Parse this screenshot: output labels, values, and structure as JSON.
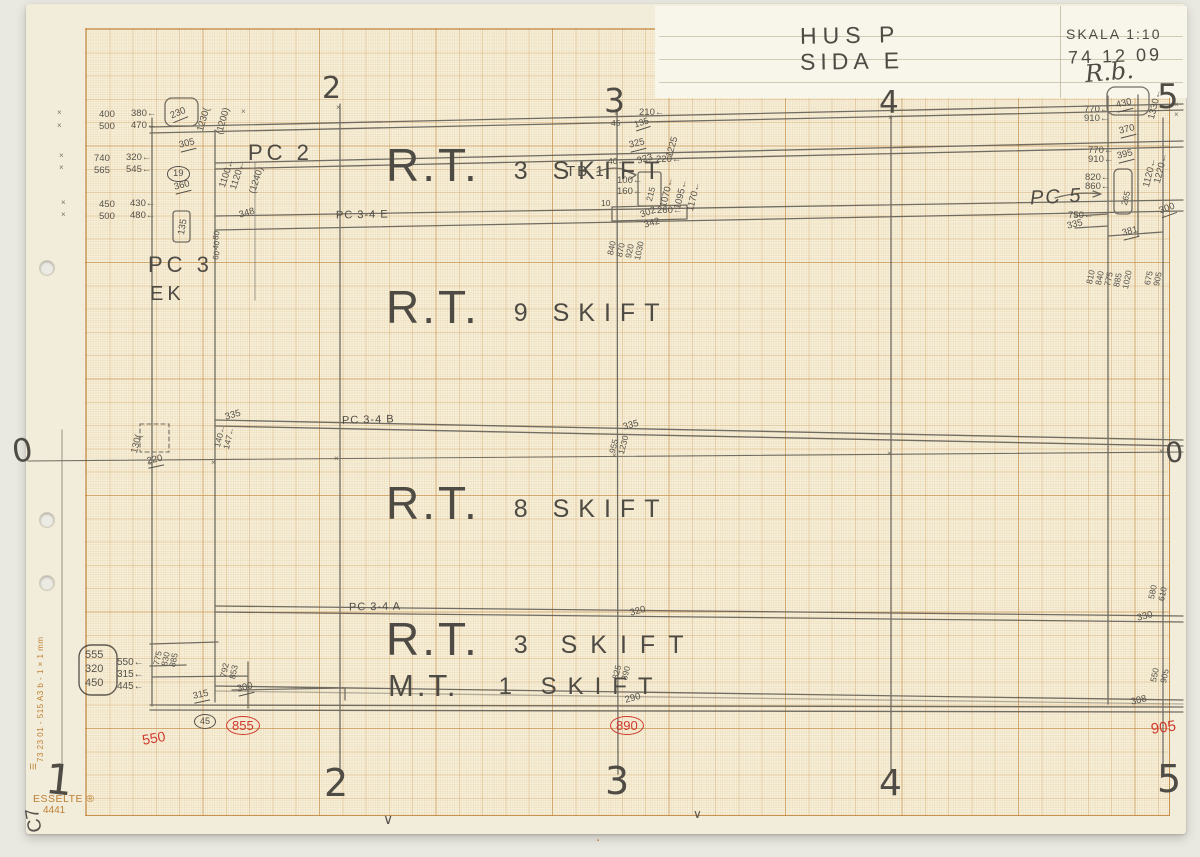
{
  "colors": {
    "pencil": "#56524b",
    "red": "#cf3a30",
    "orange": "#bd7f33",
    "paper": "#f2edda",
    "grid": "#c9955299"
  },
  "title_block": {
    "project": "HUS P",
    "side": "SIDA E",
    "scale": "SKALA 1:10",
    "date": "74 12 09",
    "signature": "R.b."
  },
  "paper": {
    "brand": "ESSELTE ®",
    "product_no": "4441",
    "margin_code": "73 23 01 - 515 A3 b - 1 × 1 mm",
    "corner_mark": "C7"
  },
  "components": {
    "pc2": "PC 2",
    "pc3": "PC 3",
    "ek": "EK",
    "pc34e": "PC 3-4 E",
    "pc34b": "PC 3-4 B",
    "pc34a": "PC 3-4 A",
    "tb1": "TB 1",
    "pc5": "PC 5"
  },
  "zones": [
    {
      "main": "R.T.",
      "sub": "3 SKIFT"
    },
    {
      "main": "R.T.",
      "sub": "9 SKIFT"
    },
    {
      "main": "R.T.",
      "sub": "8 SKIFT"
    },
    {
      "main": "R.T.",
      "sub": "3 SKIFT"
    },
    {
      "main": "M.T.",
      "sub": "1 SKIFT"
    }
  ],
  "annotations": [
    {
      "t": "2",
      "x": 322,
      "y": 74,
      "s": 30,
      "cls": "axis",
      "n": "axis-numeral-top-2"
    },
    {
      "t": "3",
      "x": 604,
      "y": 84,
      "s": 33,
      "cls": "axis",
      "n": "axis-numeral-top-3"
    },
    {
      "t": "4",
      "x": 879,
      "y": 88,
      "s": 31,
      "cls": "axis",
      "n": "axis-numeral-top-4"
    },
    {
      "t": "5",
      "x": 1157,
      "y": 80,
      "s": 34,
      "cls": "axis",
      "n": "axis-numeral-top-5"
    },
    {
      "t": "1",
      "x": 48,
      "y": 758,
      "s": 42,
      "r": 6,
      "cls": "axis",
      "n": "axis-numeral-bottom-1"
    },
    {
      "t": "2",
      "x": 324,
      "y": 764,
      "s": 38,
      "cls": "axis",
      "n": "axis-numeral-bottom-2"
    },
    {
      "t": "3",
      "x": 605,
      "y": 762,
      "s": 38,
      "cls": "axis",
      "n": "axis-numeral-bottom-3"
    },
    {
      "t": "4",
      "x": 879,
      "y": 766,
      "s": 36,
      "cls": "axis",
      "n": "axis-numeral-bottom-4"
    },
    {
      "t": "5",
      "x": 1157,
      "y": 760,
      "s": 38,
      "cls": "axis",
      "n": "axis-numeral-bottom-5"
    },
    {
      "t": "0",
      "x": 10,
      "y": 436,
      "s": 32,
      "r": -8,
      "cls": "axis",
      "n": "datum-zero-left"
    },
    {
      "t": "0",
      "x": 1164,
      "y": 440,
      "s": 28,
      "r": -6,
      "cls": "axis",
      "n": "datum-zero-right"
    },
    {
      "t": "400",
      "x": 99,
      "y": 110
    },
    {
      "t": "380←",
      "x": 131,
      "y": 109
    },
    {
      "t": "500",
      "x": 99,
      "y": 122
    },
    {
      "t": "470←",
      "x": 131,
      "y": 121
    },
    {
      "t": "230",
      "x": 169,
      "y": 112,
      "r": -22,
      "cls": "u"
    },
    {
      "t": "1230(",
      "x": 196,
      "y": 130,
      "r": -74
    },
    {
      "t": "(1200)",
      "x": 215,
      "y": 133,
      "r": -74
    },
    {
      "t": "305",
      "x": 178,
      "y": 141,
      "r": -14,
      "cls": "u"
    },
    {
      "t": "740",
      "x": 94,
      "y": 154
    },
    {
      "t": "320←",
      "x": 126,
      "y": 153
    },
    {
      "t": "565",
      "x": 94,
      "y": 166
    },
    {
      "t": "545←",
      "x": 126,
      "y": 165
    },
    {
      "t": "19",
      "x": 167,
      "y": 166,
      "cls": "circ"
    },
    {
      "t": "360",
      "x": 173,
      "y": 183,
      "r": -14,
      "cls": "u"
    },
    {
      "t": "1100←",
      "x": 218,
      "y": 186,
      "r": -72
    },
    {
      "t": "1120←",
      "x": 229,
      "y": 188,
      "r": -72
    },
    {
      "t": "(1240)",
      "x": 248,
      "y": 192,
      "r": -72
    },
    {
      "t": "450",
      "x": 99,
      "y": 200
    },
    {
      "t": "430←",
      "x": 130,
      "y": 199
    },
    {
      "t": "500",
      "x": 99,
      "y": 212
    },
    {
      "t": "480←",
      "x": 130,
      "y": 211
    },
    {
      "t": "135",
      "x": 177,
      "y": 234,
      "r": -80
    },
    {
      "t": "348",
      "x": 238,
      "y": 211,
      "r": -16
    },
    {
      "t": "80",
      "x": 212,
      "y": 239,
      "r": -78,
      "s": 8
    },
    {
      "t": "40",
      "x": 212,
      "y": 249,
      "r": -78,
      "s": 8
    },
    {
      "t": "60",
      "x": 212,
      "y": 259,
      "r": -78,
      "s": 8
    },
    {
      "t": "130(",
      "x": 130,
      "y": 452,
      "r": -76
    },
    {
      "t": "220",
      "x": 146,
      "y": 457,
      "r": -12,
      "cls": "u"
    },
    {
      "t": "335",
      "x": 224,
      "y": 413,
      "r": -16
    },
    {
      "t": "140←",
      "x": 213,
      "y": 446,
      "r": -76,
      "s": 8.5
    },
    {
      "t": "147←",
      "x": 222,
      "y": 448,
      "r": -76,
      "s": 8.5
    },
    {
      "t": "210←",
      "x": 639,
      "y": 108
    },
    {
      "t": "45",
      "x": 611,
      "y": 119,
      "s": 8.5
    },
    {
      "t": "135",
      "x": 633,
      "y": 121,
      "r": -18,
      "cls": "u",
      "s": 9
    },
    {
      "t": "325",
      "x": 628,
      "y": 141,
      "r": -14,
      "cls": "u"
    },
    {
      "t": "1225",
      "x": 665,
      "y": 156,
      "r": -74
    },
    {
      "t": "40←",
      "x": 608,
      "y": 157,
      "s": 8.5
    },
    {
      "t": "323",
      "x": 636,
      "y": 157,
      "r": -16
    },
    {
      "t": "220←",
      "x": 656,
      "y": 155
    },
    {
      "t": "100←",
      "x": 617,
      "y": 176
    },
    {
      "t": "160←",
      "x": 617,
      "y": 187
    },
    {
      "t": "215",
      "x": 645,
      "y": 200,
      "r": -76,
      "s": 8.5
    },
    {
      "t": "1070←",
      "x": 659,
      "y": 206,
      "r": -76
    },
    {
      "t": "1095←",
      "x": 673,
      "y": 208,
      "r": -76
    },
    {
      "t": "1170←",
      "x": 686,
      "y": 210,
      "r": -76
    },
    {
      "t": "10",
      "x": 601,
      "y": 199,
      "s": 8.5
    },
    {
      "t": "302",
      "x": 639,
      "y": 211,
      "r": -20
    },
    {
      "t": "342",
      "x": 643,
      "y": 221,
      "r": -16
    },
    {
      "t": "260←",
      "x": 657,
      "y": 206
    },
    {
      "t": "840",
      "x": 606,
      "y": 254,
      "r": -78,
      "s": 8.5
    },
    {
      "t": "870",
      "x": 615,
      "y": 256,
      "r": -78,
      "s": 8.5
    },
    {
      "t": "920",
      "x": 624,
      "y": 257,
      "r": -78,
      "s": 8.5
    },
    {
      "t": "1030",
      "x": 633,
      "y": 259,
      "r": -78,
      "s": 8.5
    },
    {
      "t": "335",
      "x": 622,
      "y": 423,
      "r": -15
    },
    {
      "t": "955",
      "x": 608,
      "y": 452,
      "r": -76,
      "s": 8.5
    },
    {
      "t": "1230",
      "x": 617,
      "y": 453,
      "r": -76,
      "s": 8.5
    },
    {
      "t": "320",
      "x": 629,
      "y": 609,
      "r": -15
    },
    {
      "t": "825",
      "x": 611,
      "y": 678,
      "r": -76,
      "s": 8.5
    },
    {
      "t": "890",
      "x": 620,
      "y": 679,
      "r": -76,
      "s": 8.5
    },
    {
      "t": "290",
      "x": 624,
      "y": 696,
      "r": -15
    },
    {
      "t": "890",
      "x": 610,
      "y": 716,
      "cls": "circ red",
      "s": 13,
      "n": "check-number"
    },
    {
      "t": "555",
      "x": 85,
      "y": 650,
      "s": 11
    },
    {
      "t": "320",
      "x": 85,
      "y": 664,
      "s": 11
    },
    {
      "t": "450",
      "x": 85,
      "y": 678,
      "s": 11
    },
    {
      "t": "550←",
      "x": 117,
      "y": 658,
      "s": 10
    },
    {
      "t": "315←",
      "x": 117,
      "y": 670,
      "s": 10
    },
    {
      "t": "445←",
      "x": 117,
      "y": 682,
      "s": 10
    },
    {
      "t": "775",
      "x": 152,
      "y": 664,
      "r": -78,
      "s": 8.5
    },
    {
      "t": "830",
      "x": 160,
      "y": 665,
      "r": -78,
      "s": 8.5
    },
    {
      "t": "885",
      "x": 168,
      "y": 666,
      "r": -78,
      "s": 8.5
    },
    {
      "t": "792",
      "x": 219,
      "y": 676,
      "r": -78,
      "s": 8.5
    },
    {
      "t": "853",
      "x": 228,
      "y": 678,
      "r": -78,
      "s": 8.5
    },
    {
      "t": "300",
      "x": 236,
      "y": 685,
      "r": -14,
      "cls": "u"
    },
    {
      "t": "315",
      "x": 192,
      "y": 692,
      "r": -12,
      "cls": "u"
    },
    {
      "t": "45",
      "x": 194,
      "y": 714,
      "cls": "circ",
      "s": 9
    },
    {
      "t": "855",
      "x": 226,
      "y": 716,
      "cls": "circ red",
      "s": 13,
      "n": "check-number"
    },
    {
      "t": "550",
      "x": 141,
      "y": 733,
      "cls": "red",
      "r": -10,
      "s": 14,
      "n": "check-number"
    },
    {
      "t": "430",
      "x": 1115,
      "y": 101,
      "r": -14,
      "cls": "u"
    },
    {
      "t": "770←",
      "x": 1084,
      "y": 105
    },
    {
      "t": "910←",
      "x": 1084,
      "y": 114
    },
    {
      "t": "1330←",
      "x": 1147,
      "y": 118,
      "r": -76
    },
    {
      "t": "370",
      "x": 1118,
      "y": 127,
      "r": -14,
      "cls": "u"
    },
    {
      "t": "770←",
      "x": 1088,
      "y": 146
    },
    {
      "t": "910←",
      "x": 1088,
      "y": 155
    },
    {
      "t": "395",
      "x": 1116,
      "y": 152,
      "r": -14,
      "cls": "u"
    },
    {
      "t": "1120←",
      "x": 1142,
      "y": 186,
      "r": -76
    },
    {
      "t": "1220←",
      "x": 1153,
      "y": 182,
      "r": -76
    },
    {
      "t": "820←",
      "x": 1085,
      "y": 173
    },
    {
      "t": "860←",
      "x": 1085,
      "y": 182
    },
    {
      "t": "265",
      "x": 1120,
      "y": 204,
      "r": -76,
      "s": 8.5
    },
    {
      "t": "750←",
      "x": 1068,
      "y": 211
    },
    {
      "t": "335",
      "x": 1066,
      "y": 222,
      "r": -14
    },
    {
      "t": "381",
      "x": 1121,
      "y": 229,
      "r": -14,
      "cls": "u"
    },
    {
      "t": "300",
      "x": 1158,
      "y": 207,
      "r": -20,
      "cls": "u"
    },
    {
      "t": "810",
      "x": 1085,
      "y": 283,
      "r": -78,
      "s": 8.5
    },
    {
      "t": "840",
      "x": 1094,
      "y": 284,
      "r": -78,
      "s": 8.5
    },
    {
      "t": "775",
      "x": 1103,
      "y": 285,
      "r": -78,
      "s": 8.5
    },
    {
      "t": "885",
      "x": 1112,
      "y": 286,
      "r": -78,
      "s": 8.5
    },
    {
      "t": "1020",
      "x": 1121,
      "y": 288,
      "r": -78,
      "s": 8.5
    },
    {
      "t": "675",
      "x": 1143,
      "y": 284,
      "r": -78,
      "s": 8.5
    },
    {
      "t": "905",
      "x": 1152,
      "y": 285,
      "r": -78,
      "s": 8.5
    },
    {
      "t": "580",
      "x": 1147,
      "y": 598,
      "r": -78,
      "s": 8.5
    },
    {
      "t": "610",
      "x": 1157,
      "y": 600,
      "r": -78,
      "s": 8.5
    },
    {
      "t": "330",
      "x": 1136,
      "y": 614,
      "r": -14
    },
    {
      "t": "550",
      "x": 1149,
      "y": 681,
      "r": -78,
      "s": 8.5
    },
    {
      "t": "905",
      "x": 1159,
      "y": 682,
      "r": -78,
      "s": 8.5
    },
    {
      "t": "308",
      "x": 1130,
      "y": 698,
      "r": -14
    },
    {
      "t": "905",
      "x": 1150,
      "y": 722,
      "cls": "red",
      "r": -8,
      "s": 15,
      "n": "check-number"
    },
    {
      "t": "×",
      "x": 57,
      "y": 109,
      "s": 8,
      "cls": "tick",
      "n": "tick-mark"
    },
    {
      "t": "×",
      "x": 57,
      "y": 122,
      "s": 8,
      "cls": "tick",
      "n": "tick-mark"
    },
    {
      "t": "×",
      "x": 59,
      "y": 152,
      "s": 8,
      "cls": "tick",
      "n": "tick-mark"
    },
    {
      "t": "×",
      "x": 59,
      "y": 164,
      "s": 8,
      "cls": "tick",
      "n": "tick-mark"
    },
    {
      "t": "×",
      "x": 61,
      "y": 199,
      "s": 8,
      "cls": "tick",
      "n": "tick-mark"
    },
    {
      "t": "×",
      "x": 61,
      "y": 211,
      "s": 8,
      "cls": "tick",
      "n": "tick-mark"
    },
    {
      "t": "×",
      "x": 334,
      "y": 455,
      "s": 8,
      "cls": "tick",
      "n": "tick-mark"
    },
    {
      "t": "×",
      "x": 612,
      "y": 452,
      "s": 8,
      "cls": "tick",
      "n": "tick-mark"
    },
    {
      "t": "×",
      "x": 887,
      "y": 450,
      "s": 8,
      "cls": "tick",
      "n": "tick-mark"
    },
    {
      "t": "×",
      "x": 1159,
      "y": 448,
      "s": 8,
      "cls": "tick",
      "n": "tick-mark"
    },
    {
      "t": "×",
      "x": 211,
      "y": 459,
      "s": 8,
      "cls": "tick",
      "n": "tick-mark"
    },
    {
      "t": "×",
      "x": 148,
      "y": 460,
      "s": 8,
      "cls": "tick",
      "n": "tick-mark"
    },
    {
      "t": "×",
      "x": 1174,
      "y": 101,
      "s": 8,
      "cls": "tick",
      "n": "tick-mark"
    },
    {
      "t": "×",
      "x": 1174,
      "y": 111,
      "s": 8,
      "cls": "tick",
      "n": "tick-mark"
    },
    {
      "t": "×",
      "x": 336,
      "y": 104,
      "s": 8,
      "cls": "tick",
      "n": "tick-mark"
    },
    {
      "t": "×",
      "x": 614,
      "y": 110,
      "s": 8,
      "cls": "tick",
      "n": "tick-mark"
    },
    {
      "t": "×",
      "x": 888,
      "y": 114,
      "s": 8,
      "cls": "tick",
      "n": "tick-mark"
    },
    {
      "t": "×",
      "x": 241,
      "y": 108,
      "s": 8,
      "cls": "tick",
      "n": "tick-mark"
    },
    {
      "t": "∨",
      "x": 383,
      "y": 812,
      "s": 14,
      "n": "edge-mark"
    },
    {
      "t": "∨",
      "x": 693,
      "y": 808,
      "s": 12,
      "n": "edge-mark"
    },
    {
      "t": "▪",
      "x": 597,
      "y": 838,
      "s": 6,
      "cls": "orange",
      "n": "edge-mark"
    },
    {
      "t": "☰",
      "x": 30,
      "y": 770,
      "s": 8,
      "r": -90,
      "cls": "orange",
      "n": "esselte-logo-icon"
    }
  ]
}
